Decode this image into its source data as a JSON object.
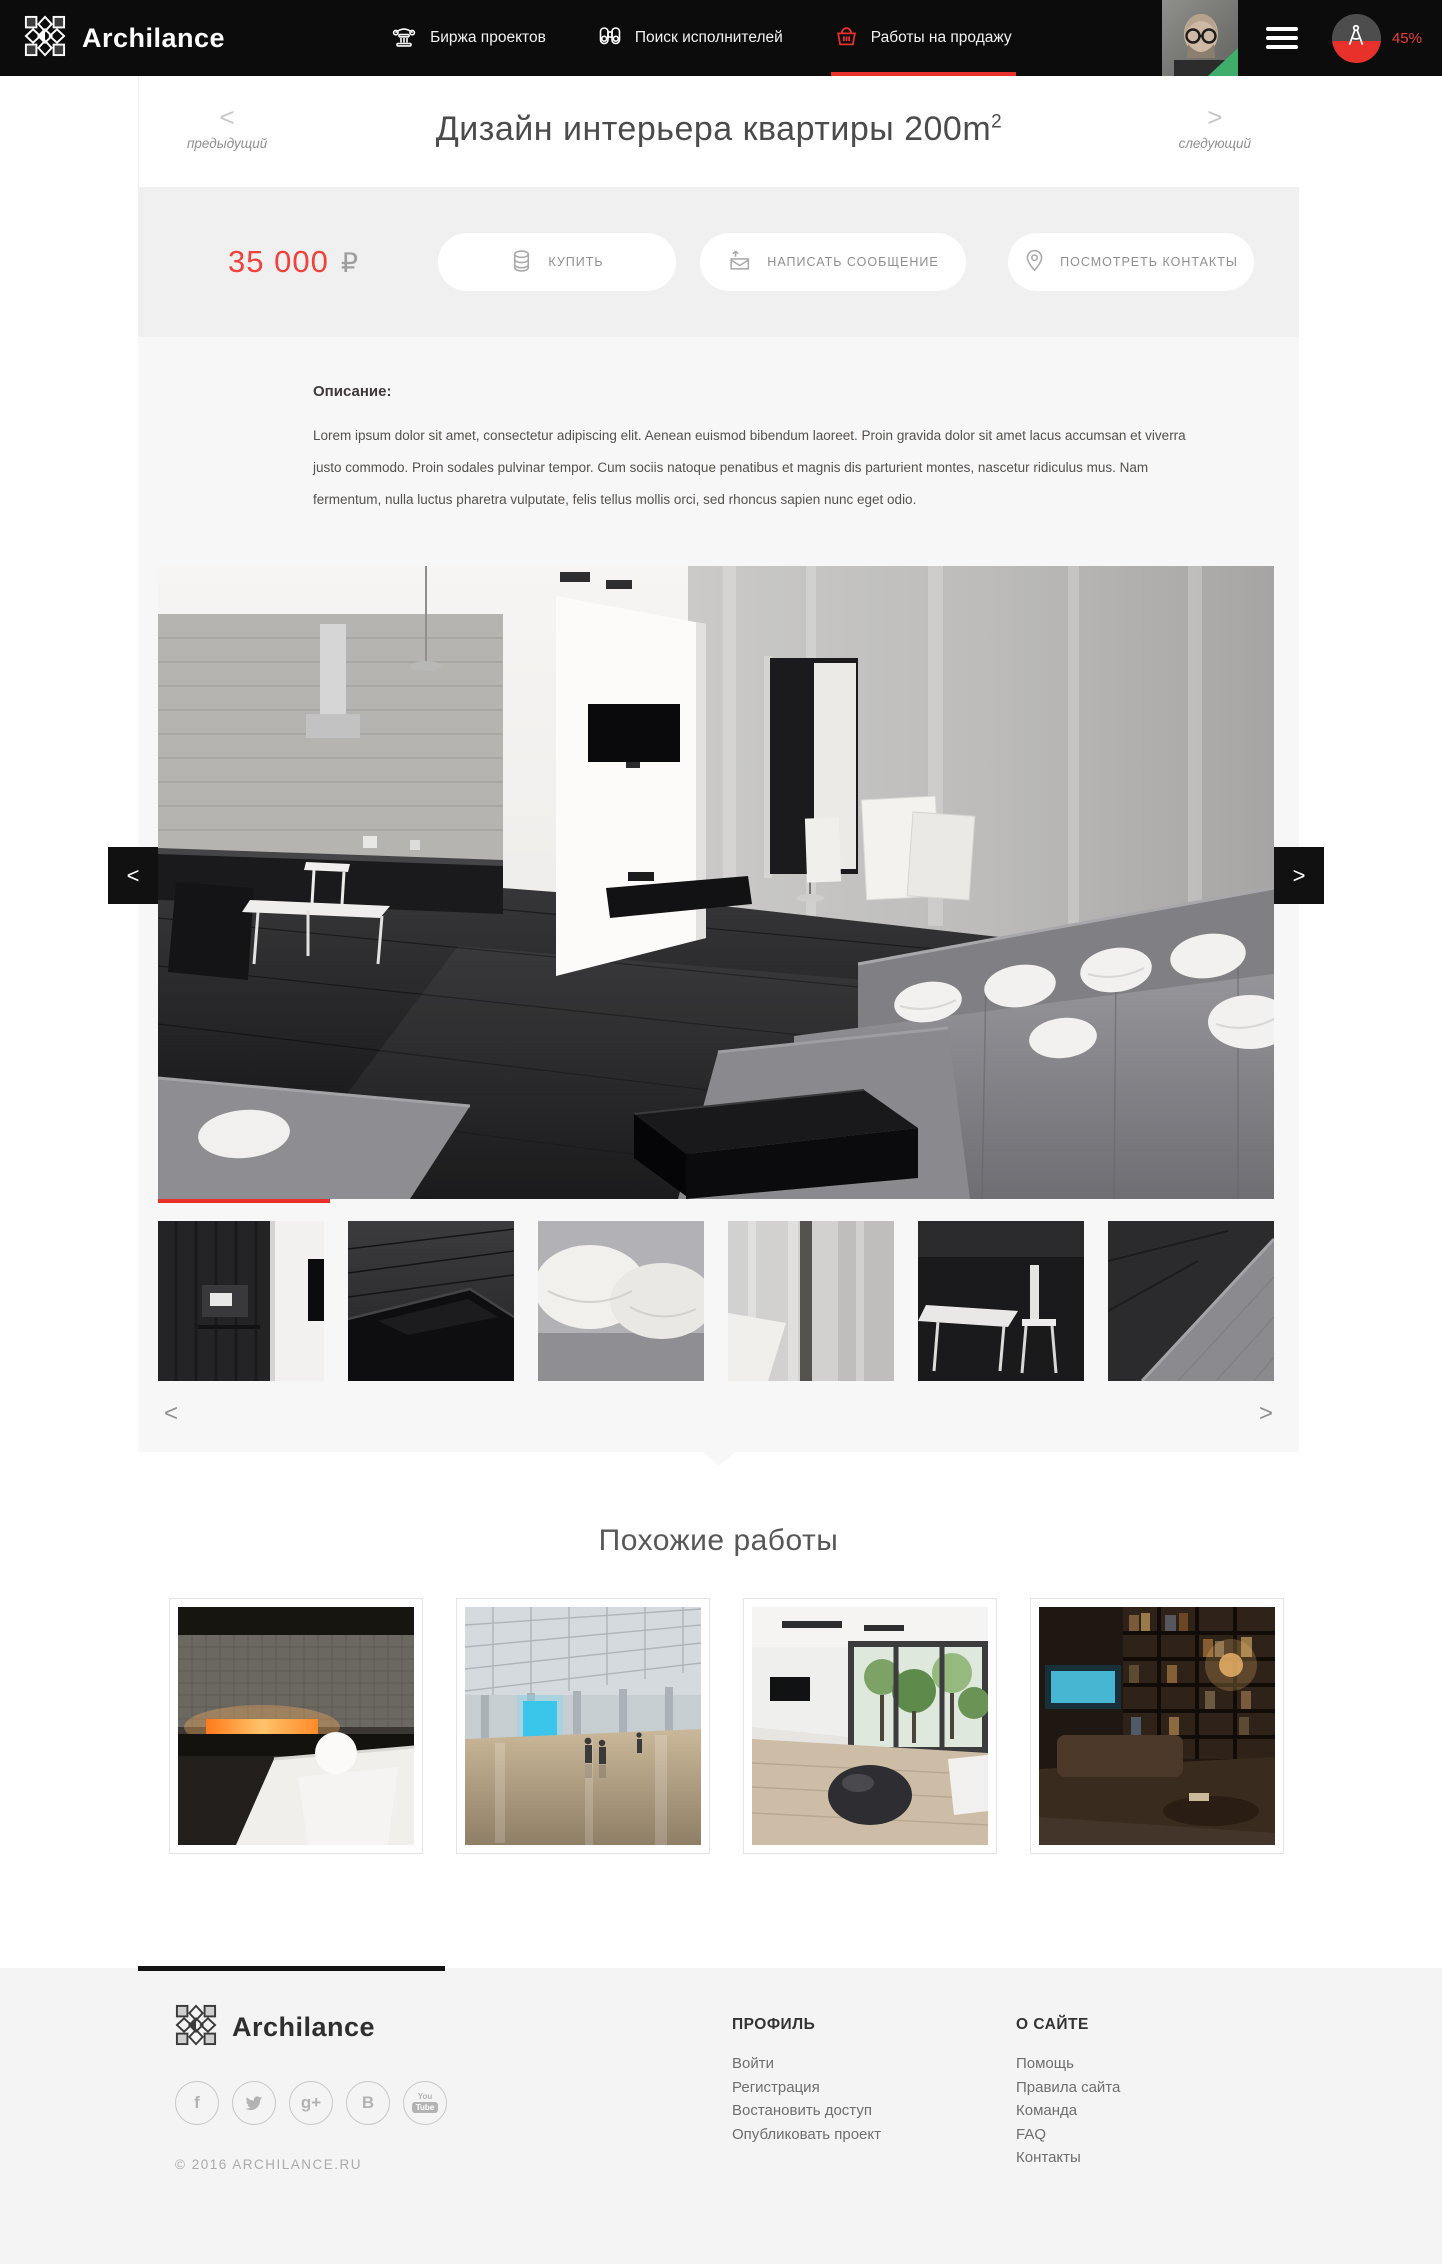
{
  "accent_color": "#e8312a",
  "navbar": {
    "brand": "Archilance",
    "items": [
      {
        "label": "Биржа проектов",
        "icon": "column-icon"
      },
      {
        "label": "Поиск исполнителей",
        "icon": "binoculars-icon"
      },
      {
        "label": "Работы на продажу",
        "icon": "basket-icon",
        "active": true
      }
    ],
    "progress_label": "45%"
  },
  "work": {
    "prev_arrow": "<",
    "prev_label": "предыдущий",
    "next_arrow": ">",
    "next_label": "следующий",
    "title": "Дизайн интерьера квартиры 200m",
    "title_sup": "2",
    "price": "35 000",
    "currency": "₽",
    "actions": [
      {
        "label": "КУПИТЬ",
        "icon": "coins-icon"
      },
      {
        "label": "НАПИСАТЬ СООБЩЕНИЕ",
        "icon": "message-icon"
      },
      {
        "label": "ПОСМОТРЕТЬ КОНТАКТЫ",
        "icon": "pin-icon"
      }
    ],
    "description_heading": "Описание:",
    "description": "Lorem ipsum dolor sit amet, consectetur adipiscing elit. Aenean euismod bibendum laoreet. Proin gravida dolor sit amet lacus accumsan et viverra justo commodo. Proin sodales pulvinar tempor. Cum sociis natoque penatibus et magnis dis parturient montes, nascetur ridiculus mus. Nam fermentum, nulla luctus pharetra vulputate, felis tellus mollis orci, sed rhoncus sapien nunc eget odio."
  },
  "gallery": {
    "side_prev": "<",
    "side_next": ">",
    "thumbs_prev": "<",
    "thumbs_next": ">"
  },
  "similar": {
    "heading": "Похожие работы"
  },
  "footer": {
    "brand": "Archilance",
    "copyright": "© 2016 ARCHILANCE.RU",
    "social": {
      "facebook_glyph": "f",
      "gplus_glyph": "g+",
      "vk_glyph": "B",
      "youtube_top": "You",
      "youtube_bottom": "Tube"
    },
    "columns": [
      {
        "heading": "ПРОФИЛЬ",
        "links": [
          "Войти",
          "Регистрация",
          "Востановить доступ",
          "Опубликовать проект"
        ]
      },
      {
        "heading": "О САЙТЕ",
        "links": [
          "Помощь",
          "Правила сайта",
          "Команда",
          "FAQ",
          "Контакты"
        ]
      }
    ]
  }
}
